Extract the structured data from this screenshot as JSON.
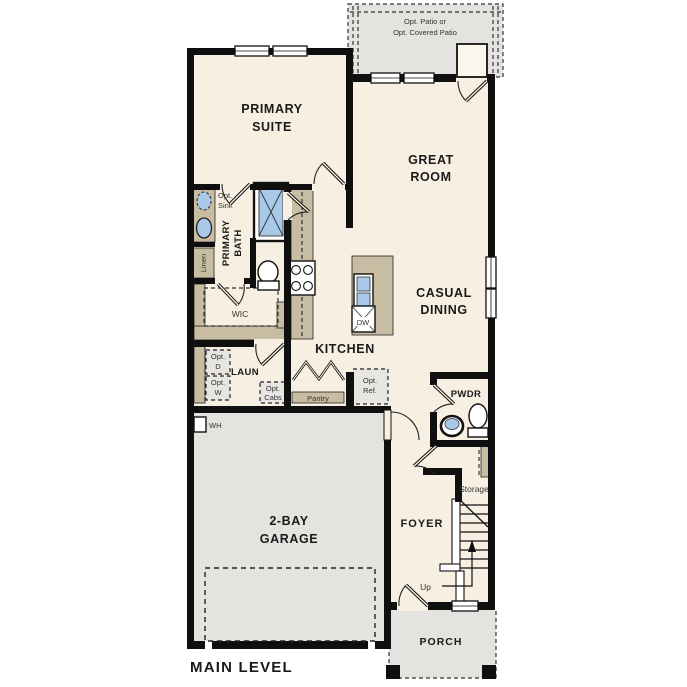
{
  "meta": {
    "type": "residential-floor-plan",
    "level_title": "MAIN LEVEL"
  },
  "colors": {
    "interior_cream": "#F7F0E2",
    "exterior_gray": "#E4E3DF",
    "cabinet_tan": "#C8BCA2",
    "fixture_blue": "#A9C9E9",
    "wall_black": "#0f0f0f",
    "label_text": "#1a1a1a"
  },
  "labels": {
    "plan_title": "MAIN LEVEL",
    "patio_line1": "Opt. Patio or",
    "patio_line2": "Opt. Covered Patio",
    "primary_suite_line1": "PRIMARY",
    "primary_suite_line2": "SUITE",
    "great_room_line1": "GREAT",
    "great_room_line2": "ROOM",
    "casual_dining_line1": "CASUAL",
    "casual_dining_line2": "DINING",
    "kitchen": "KITCHEN",
    "primary_bath_line1": "PRIMARY",
    "primary_bath_line2": "BATH",
    "opt_sink_line1": "Opt.",
    "opt_sink_line2": "Sink",
    "linen": "Linen",
    "wic": "WIC",
    "laundry": "LAUN",
    "opt_dryer_line1": "Opt.",
    "opt_dryer_line2": "D",
    "opt_washer_line1": "Opt.",
    "opt_washer_line2": "W",
    "opt_cabs_line1": "Opt.",
    "opt_cabs_line2": "Cabs",
    "pantry": "Pantry",
    "opt_ref_line1": "Opt.",
    "opt_ref_line2": "Ref.",
    "dishwasher": "DW",
    "water_heater": "WH",
    "pwdr": "PWDR",
    "storage": "Storage",
    "foyer": "FOYER",
    "up": "Up",
    "garage_line1": "2-BAY",
    "garage_line2": "GARAGE",
    "porch": "PORCH"
  }
}
